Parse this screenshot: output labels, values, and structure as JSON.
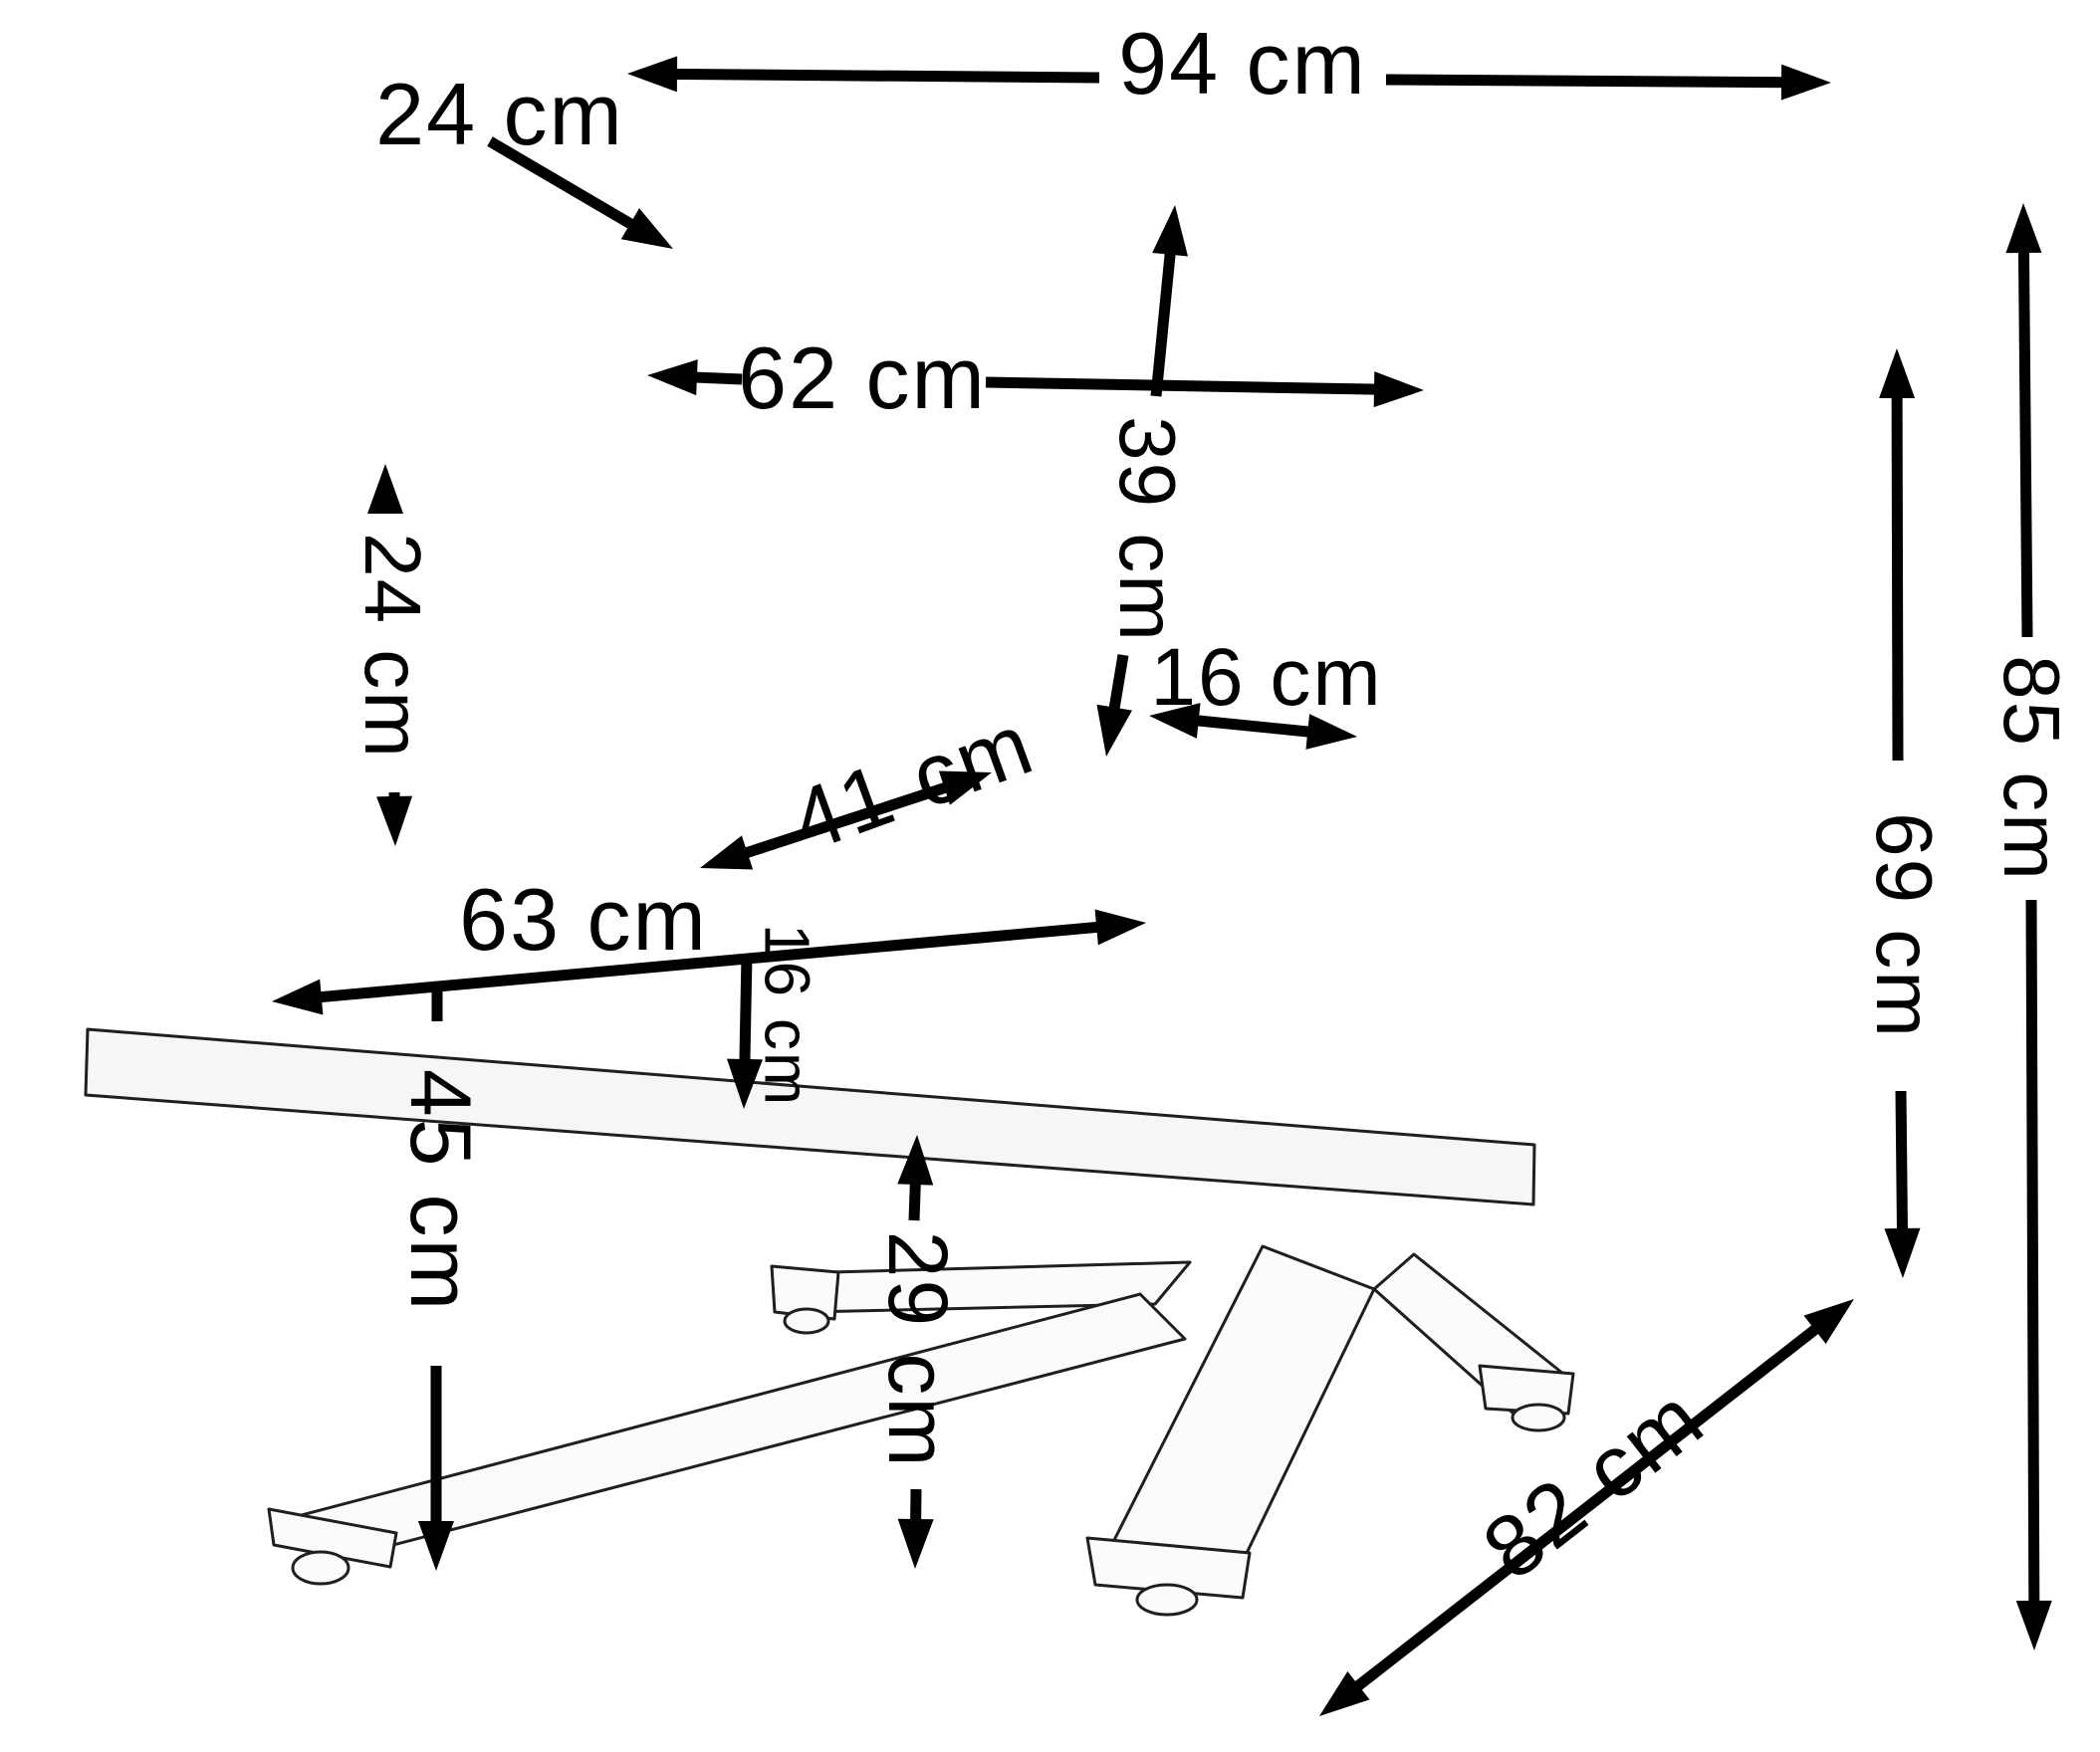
{
  "title": "Armchair dimensions diagram",
  "unit": "cm",
  "measurements": [
    {
      "key": "overall_width",
      "label": "94 cm",
      "value": 94
    },
    {
      "key": "back_cushion_thickness",
      "label": "24 cm",
      "value": 24
    },
    {
      "key": "back_cushion_width",
      "label": "62 cm",
      "value": 62
    },
    {
      "key": "back_cushion_height",
      "label": "39 cm",
      "value": 39
    },
    {
      "key": "armrest_height_above_seat",
      "label": "24 cm",
      "value": 24
    },
    {
      "key": "armrest_width",
      "label": "16 cm",
      "value": 16
    },
    {
      "key": "seat_depth",
      "label": "41 cm",
      "value": 41
    },
    {
      "key": "seat_width",
      "label": "63 cm",
      "value": 63
    },
    {
      "key": "seat_cushion_thickness",
      "label": "16 cm",
      "value": 16
    },
    {
      "key": "seat_height",
      "label": "45 cm",
      "value": 45
    },
    {
      "key": "ground_clearance",
      "label": "29 cm",
      "value": 29
    },
    {
      "key": "height_to_armrest",
      "label": "69 cm",
      "value": 69
    },
    {
      "key": "overall_height",
      "label": "85 cm",
      "value": 85
    },
    {
      "key": "overall_depth",
      "label": "82 cm",
      "value": 82
    }
  ]
}
